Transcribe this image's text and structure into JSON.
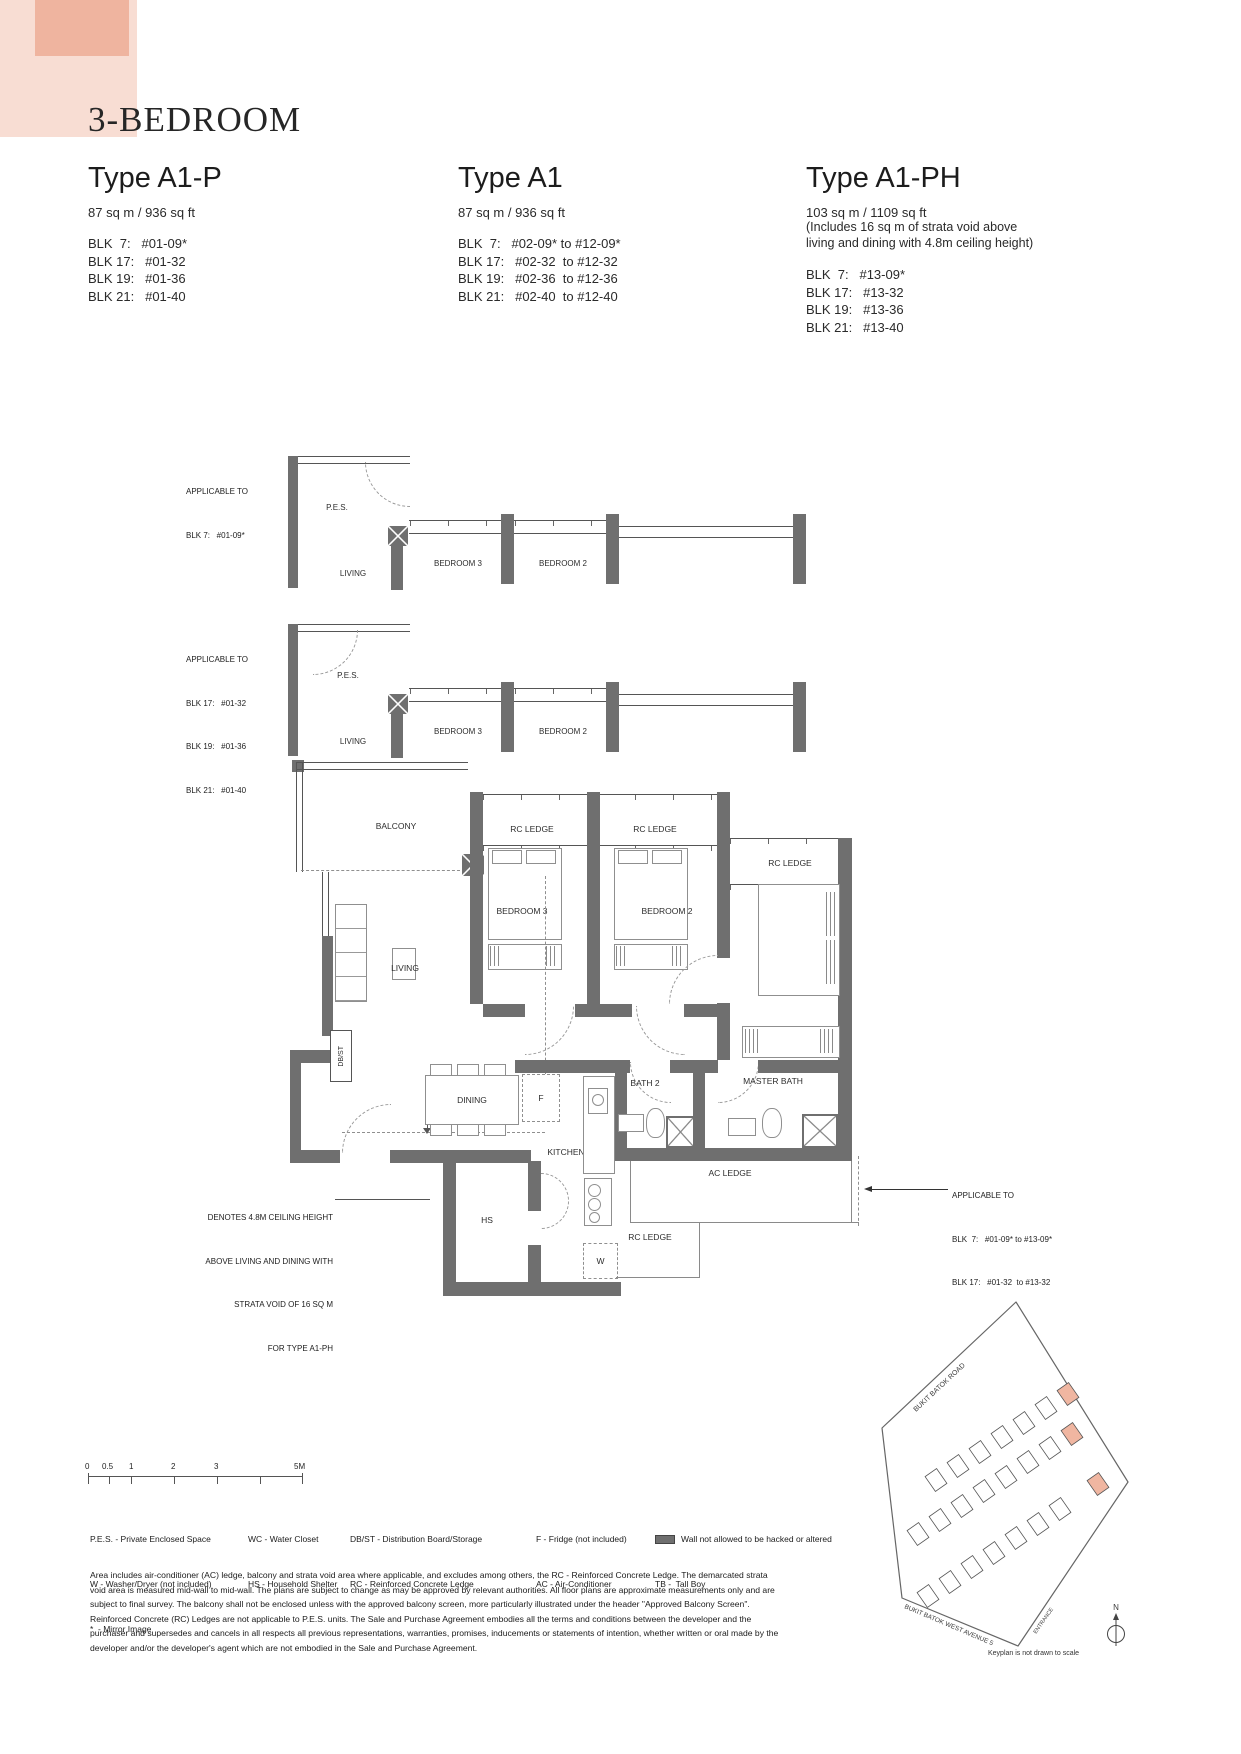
{
  "page": {
    "title": "3-BEDROOM"
  },
  "types": [
    {
      "name": "Type A1-P",
      "area": "87 sq m / 936 sq ft",
      "blocks": [
        "BLK  7:   #01-09*",
        "BLK 17:   #01-32",
        "BLK 19:   #01-36",
        "BLK 21:   #01-40"
      ]
    },
    {
      "name": "Type A1",
      "area": "87 sq m / 936 sq ft",
      "blocks": [
        "BLK  7:   #02-09* to #12-09*",
        "BLK 17:   #02-32  to #12-32",
        "BLK 19:   #02-36  to #12-36",
        "BLK 21:   #02-40  to #12-40"
      ]
    },
    {
      "name": "Type A1-PH",
      "area": "103 sq m / 1109 sq ft",
      "note1": "(Includes 16 sq m of strata void above",
      "note2": "living and dining with 4.8m ceiling height)",
      "blocks": [
        "BLK  7:   #13-09*",
        "BLK 17:   #13-32",
        "BLK 19:   #13-36",
        "BLK 21:   #13-40"
      ]
    }
  ],
  "labels": {
    "pes": "P.E.S.",
    "living": "LIVING",
    "bedroom3": "BEDROOM 3",
    "bedroom2": "BEDROOM 2",
    "master_bedroom": "MASTER BEDROOM",
    "balcony": "BALCONY",
    "rc_ledge": "RC LEDGE",
    "dbst": "DB/ST",
    "dining": "DINING",
    "fridge": "F",
    "kitchen": "KITCHEN",
    "bath2": "BATH 2",
    "master_bath": "MASTER BATH",
    "ac_ledge": "AC LEDGE",
    "hs": "HS",
    "washer": "W"
  },
  "annotations": {
    "plan1": {
      "l1": "APPLICABLE TO",
      "l2": "BLK 7:   #01-09*"
    },
    "plan2": {
      "l1": "APPLICABLE TO",
      "l2": "BLK 17:   #01-32",
      "l3": "BLK 19:   #01-36",
      "l4": "BLK 21:   #01-40"
    },
    "ceiling": {
      "l1": "DENOTES 4.8M CEILING HEIGHT",
      "l2": "ABOVE LIVING AND DINING WITH",
      "l3": "STRATA VOID OF 16 SQ M",
      "l4": "FOR TYPE A1-PH"
    },
    "right": {
      "l1": "APPLICABLE TO",
      "l2": "BLK  7:   #01-09* to #13-09*",
      "l3": "BLK 17:   #01-32  to #13-32"
    }
  },
  "scalebar": {
    "t0": "0",
    "t1": "0.5",
    "t2": "1",
    "t3": "2",
    "t4": "3",
    "t5": "5M"
  },
  "legend": {
    "c1_1": "P.E.S. - Private Enclosed Space",
    "c1_2": "W - Washer/Dryer (not included)",
    "c1_3": "*  - Mirror Image",
    "c2_1": "WC - Water Closet",
    "c2_2": "HS - Household Shelter",
    "c3_1": "DB/ST - Distribution Board/Storage",
    "c3_2": "RC - Reinforced Concrete Ledge",
    "c4_1": "F - Fridge (not included)",
    "c4_2": "AC - Air-Conditioner",
    "c5_1": "Wall not allowed to be hacked or altered",
    "c5_2": "TB -  Tall Boy"
  },
  "disclaimer": "Area includes air-conditioner (AC) ledge, balcony and strata void area where applicable, and excludes among others, the RC - Reinforced Concrete Ledge. The demarcated strata void area is measured mid-wall to mid-wall. The plans are subject to change as may be approved by relevant authorities. All floor plans are approximate measurements only and are subject to final survey. The balcony shall not be enclosed unless with the approved balcony screen, more particularly illustrated under the header \"Approved Balcony Screen\". Reinforced Concrete (RC) Ledges are not applicable to P.E.S. units. The Sale and Purchase Agreement embodies all the terms and conditions between the developer and the purchaser and supersedes and cancels in all respects all previous representations, warranties, promises, inducements or statements of intention, whether written or oral made by the developer and/or the developer's agent which are not embodied in the Sale and Purchase Agreement.",
  "keyplan": {
    "road1": "BUKIT BATOK ROAD",
    "road2": "BUKIT BATOK WEST AVENUE 5",
    "entrance": "ENTRANCE",
    "note": "Keyplan is not drawn to scale",
    "compass_n": "N"
  },
  "colors": {
    "accent_light": "#f8ddd3",
    "accent_dark": "#efb49f",
    "wall_gray": "#6f6f6f",
    "keyplan_highlight": "#f0b6a1"
  }
}
